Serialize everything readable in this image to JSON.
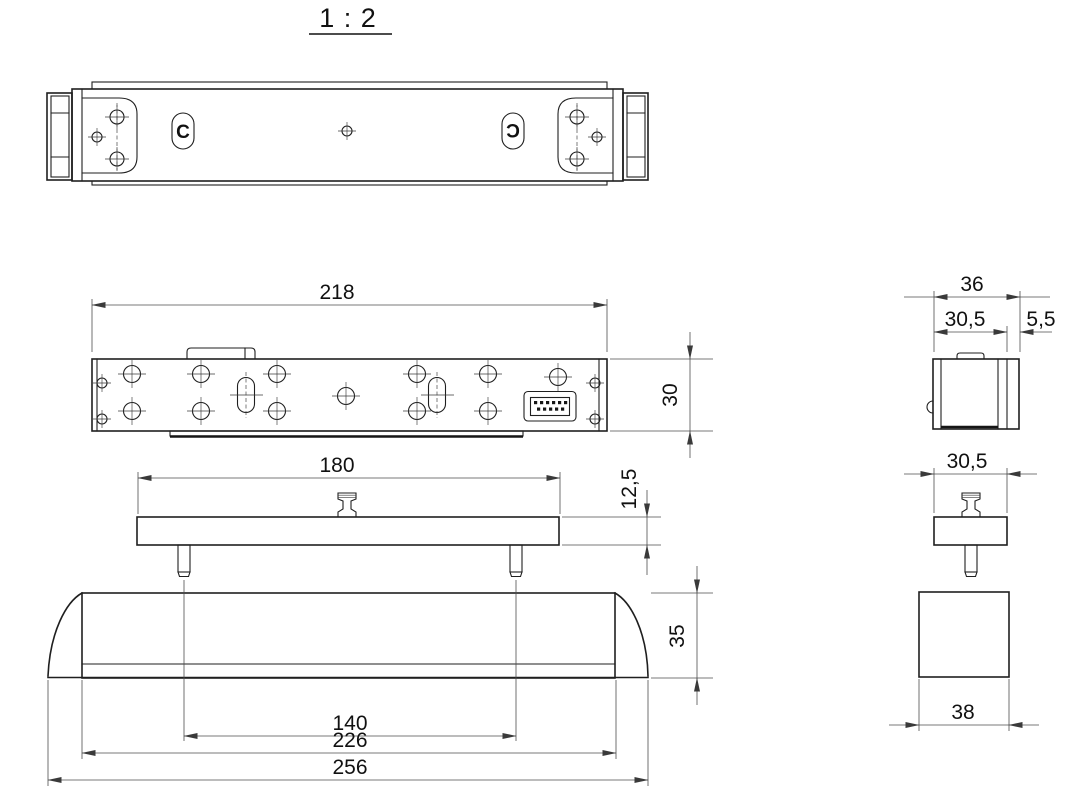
{
  "title": "1 : 2",
  "labels": {
    "front_width": "218",
    "front_height": "30",
    "plate_width": "180",
    "plate_thickness": "12,5",
    "pin_spacing": "140",
    "housing_body_width": "226",
    "housing_overall_width": "256",
    "housing_height": "35",
    "lock_overall_depth": "36",
    "lock_body_depth": "30,5",
    "lock_flange_depth": "5,5",
    "plate_depth": "30,5",
    "housing_depth": "38",
    "marker_left": "C",
    "marker_right": "C"
  },
  "colors": {
    "outline": "#1f1f1f",
    "dimension": "#4d4d4d",
    "text": "#111111",
    "background": "#ffffff"
  }
}
